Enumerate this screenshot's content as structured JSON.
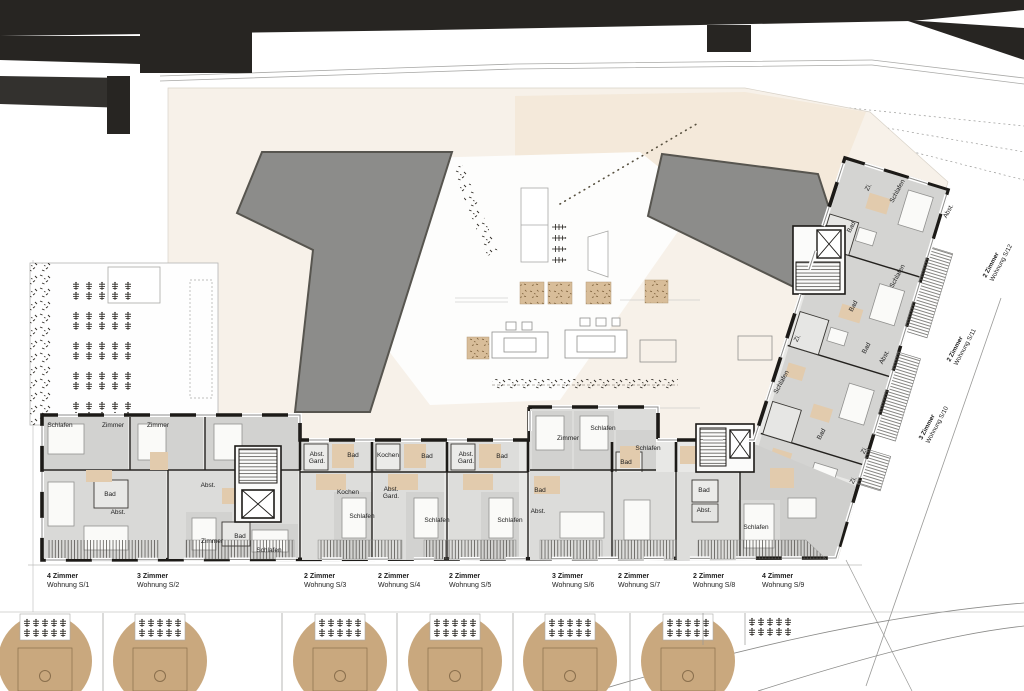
{
  "plan": {
    "room_labels": [
      {
        "t": "Schlafen",
        "x": 60,
        "y": 427
      },
      {
        "t": "Zimmer",
        "x": 113,
        "y": 427
      },
      {
        "t": "Zimmer",
        "x": 158,
        "y": 427
      },
      {
        "t": "Bad",
        "x": 110,
        "y": 496
      },
      {
        "t": "Abst.",
        "x": 118,
        "y": 514
      },
      {
        "t": "Abst.",
        "x": 208,
        "y": 487
      },
      {
        "t": "Zimmer",
        "x": 212,
        "y": 543
      },
      {
        "t": "Bad",
        "x": 240,
        "y": 538
      },
      {
        "t": "Schlafen",
        "x": 269,
        "y": 552
      },
      {
        "t": "Abst.",
        "x": 317,
        "y": 456
      },
      {
        "t": "Gard.",
        "x": 317,
        "y": 463
      },
      {
        "t": "Bad",
        "x": 353,
        "y": 457
      },
      {
        "t": "Kochen",
        "x": 388,
        "y": 457
      },
      {
        "t": "Bad",
        "x": 427,
        "y": 458
      },
      {
        "t": "Abst.",
        "x": 466,
        "y": 456
      },
      {
        "t": "Gard.",
        "x": 466,
        "y": 463
      },
      {
        "t": "Bad",
        "x": 502,
        "y": 458
      },
      {
        "t": "Kochen",
        "x": 348,
        "y": 494
      },
      {
        "t": "Abst.",
        "x": 391,
        "y": 491
      },
      {
        "t": "Gard.",
        "x": 391,
        "y": 498
      },
      {
        "t": "Schlafen",
        "x": 362,
        "y": 518
      },
      {
        "t": "Schlafen",
        "x": 437,
        "y": 522
      },
      {
        "t": "Schlafen",
        "x": 510,
        "y": 522
      },
      {
        "t": "Bad",
        "x": 540,
        "y": 492
      },
      {
        "t": "Abst.",
        "x": 538,
        "y": 513
      },
      {
        "t": "Zimmer",
        "x": 568,
        "y": 440
      },
      {
        "t": "Schlafen",
        "x": 603,
        "y": 430
      },
      {
        "t": "Schlafen",
        "x": 648,
        "y": 450
      },
      {
        "t": "Bad",
        "x": 626,
        "y": 464
      },
      {
        "t": "Bad",
        "x": 704,
        "y": 492
      },
      {
        "t": "Abst.",
        "x": 704,
        "y": 512
      },
      {
        "t": "Schlafen",
        "x": 756,
        "y": 529
      },
      {
        "t": "Zi.",
        "x": 870,
        "y": 188,
        "r": -62
      },
      {
        "t": "Schlafen",
        "x": 899,
        "y": 192,
        "r": -62
      },
      {
        "t": "Abst.",
        "x": 950,
        "y": 212,
        "r": -62
      },
      {
        "t": "Bad",
        "x": 853,
        "y": 228,
        "r": -62
      },
      {
        "t": "Schlafen",
        "x": 899,
        "y": 277,
        "r": -62
      },
      {
        "t": "Bad",
        "x": 855,
        "y": 307,
        "r": -62
      },
      {
        "t": "Zi.",
        "x": 799,
        "y": 339,
        "r": -62
      },
      {
        "t": "Bad",
        "x": 868,
        "y": 349,
        "r": -62
      },
      {
        "t": "Abst.",
        "x": 886,
        "y": 358,
        "r": -62
      },
      {
        "t": "Schlafen",
        "x": 783,
        "y": 383,
        "r": -62
      },
      {
        "t": "Bad",
        "x": 823,
        "y": 435,
        "r": -62
      },
      {
        "t": "Zi.",
        "x": 866,
        "y": 451,
        "r": -62
      },
      {
        "t": "Zi.",
        "x": 855,
        "y": 481,
        "r": -62
      }
    ],
    "apartment_labels": [
      {
        "rooms": "4 Zimmer",
        "unit": "Wohnung S/1",
        "x": 47
      },
      {
        "rooms": "3 Zimmer",
        "unit": "Wohnung S/2",
        "x": 137
      },
      {
        "rooms": "2 Zimmer",
        "unit": "Wohnung S/3",
        "x": 304
      },
      {
        "rooms": "2 Zimmer",
        "unit": "Wohnung S/4",
        "x": 378
      },
      {
        "rooms": "2 Zimmer",
        "unit": "Wohnung S/5",
        "x": 449
      },
      {
        "rooms": "3 Zimmer",
        "unit": "Wohnung S/6",
        "x": 552
      },
      {
        "rooms": "2 Zimmer",
        "unit": "Wohnung S/7",
        "x": 618
      },
      {
        "rooms": "2 Zimmer",
        "unit": "Wohnung S/8",
        "x": 693
      },
      {
        "rooms": "4 Zimmer",
        "unit": "Wohnung S/9",
        "x": 762
      }
    ],
    "rotated_unit_labels": [
      {
        "rooms": "2 Zimmer",
        "unit": "Wohnung S/12",
        "x": 986,
        "y": 278,
        "r": -62
      },
      {
        "rooms": "2 Zimmer",
        "unit": "Wohnung S/11",
        "x": 950,
        "y": 362,
        "r": -62
      },
      {
        "rooms": "3 Zimmer",
        "unit": "Wohnung S/10",
        "x": 922,
        "y": 440,
        "r": -62
      }
    ]
  },
  "site": {
    "tree_x": [
      45,
      160,
      340,
      455,
      570,
      688
    ]
  },
  "colors": {
    "neighbor_black": "#272522",
    "wall_black": "#1c1a17",
    "roof_gray": "#8c8c8a",
    "room_gray": "#d6d6d4",
    "tan_accent": "#e2cbad",
    "tree_tan": "#c9a87e",
    "court_cream": "#f6efe6"
  }
}
